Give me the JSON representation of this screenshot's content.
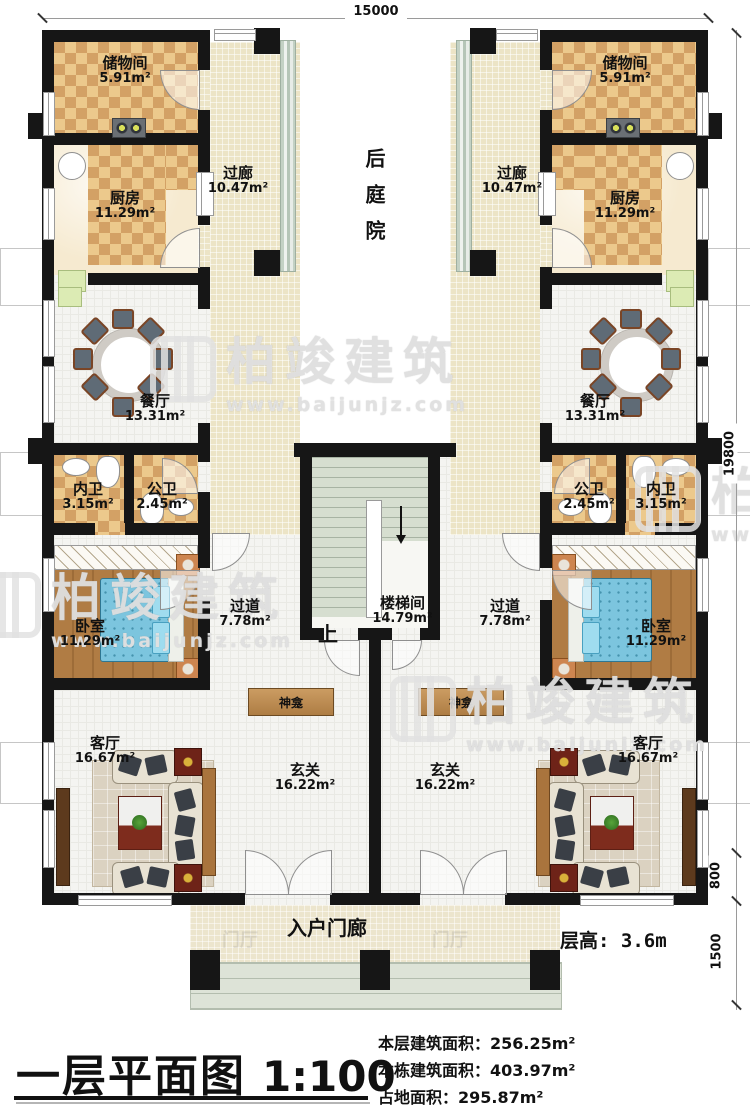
{
  "watermark": {
    "brand": "柏竣建筑",
    "url": "www.baijunjz.com"
  },
  "dimensions": {
    "top": "15000",
    "right": "19800",
    "offset_800": "800",
    "offset_1500": "1500"
  },
  "floor_height": "层高: 3.6m",
  "rooms": {
    "storage": {
      "label": "储物间",
      "area": "5.91m²"
    },
    "kitchen": {
      "label": "厨房",
      "area": "11.29m²"
    },
    "gallery": {
      "label": "过廊",
      "area": "10.47m²"
    },
    "courtyard": {
      "label": "后庭院"
    },
    "dining": {
      "label": "餐厅",
      "area": "13.31m²"
    },
    "ensuite_bath": {
      "label": "内卫",
      "area": "3.15m²"
    },
    "public_bath": {
      "label": "公卫",
      "area": "2.45m²"
    },
    "bedroom": {
      "label": "卧室",
      "area": "11.29m²"
    },
    "passage": {
      "label": "过道",
      "area": "7.78m²"
    },
    "stairwell": {
      "label": "楼梯间",
      "area": "14.79m²",
      "up": "上"
    },
    "shrine": {
      "label": "神龛"
    },
    "living": {
      "label": "客厅",
      "area": "16.67m²"
    },
    "foyer": {
      "label": "玄关",
      "area": "16.22m²"
    },
    "porch": {
      "label": "入户门廊",
      "ghost": "门厅"
    }
  },
  "titleblock": {
    "title": "一层平面图",
    "scale": "1:100",
    "stats": [
      {
        "label": "本层建筑面积：",
        "value": "256.25m²"
      },
      {
        "label": "本栋建筑面积：",
        "value": "403.97m²"
      },
      {
        "label": "占地面积：",
        "value": "295.87m²"
      }
    ]
  }
}
